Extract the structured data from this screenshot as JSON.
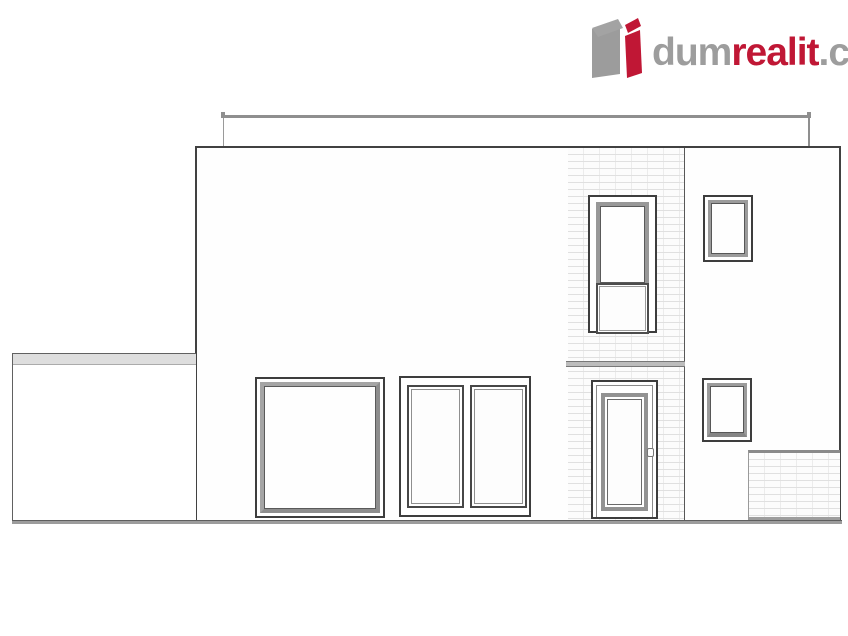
{
  "brand": {
    "name_part1": "dum",
    "name_part2": "realit",
    "name_part3": ".cz",
    "colors": {
      "accent": "#c01735",
      "gray": "#9d9d9d"
    },
    "icon": "dumrealit-cube-icon"
  },
  "drawing": {
    "type": "architectural-front-elevation",
    "elements": [
      "flat-roof-parapet",
      "main-facade",
      "brick-accent-strip",
      "large-fixed-window",
      "double-casement-window",
      "stair-window-with-lower-panel",
      "entrance-door",
      "small-window-upper-right",
      "small-window-lower-right",
      "low-wall-left",
      "brick-wall-bottom-right",
      "ground-line"
    ],
    "colors": {
      "outline": "#414141",
      "frame_gray": "#9a9a9a",
      "brick_line": "#e0e0e0",
      "ground": "#9c9c9c"
    }
  }
}
